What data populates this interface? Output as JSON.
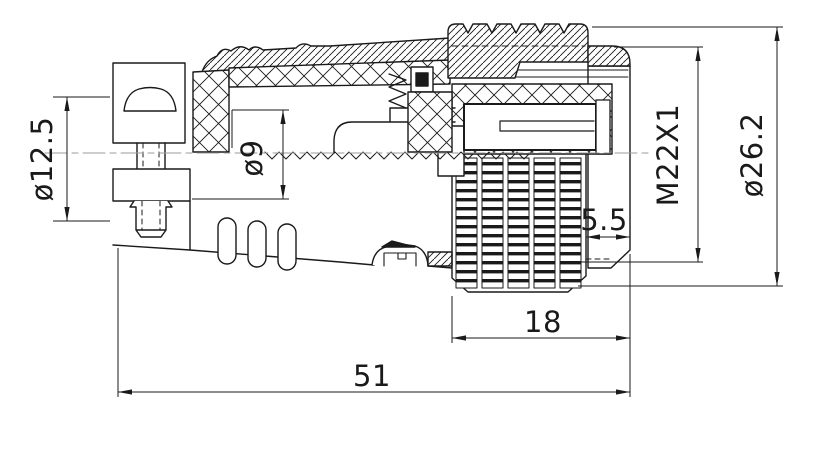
{
  "drawing": {
    "background_color": "#ffffff",
    "line_color": "#1a1a1a",
    "centerline_color": "#9b9b9b",
    "dimensions": {
      "clamp_diameter": "ø12.5",
      "cable_entry_diameter": "ø9",
      "thread_spec": "M22X1",
      "outer_diameter": "ø26.2",
      "rear_gap": "5.5",
      "coupling_length": "18",
      "overall_length": "51"
    }
  }
}
